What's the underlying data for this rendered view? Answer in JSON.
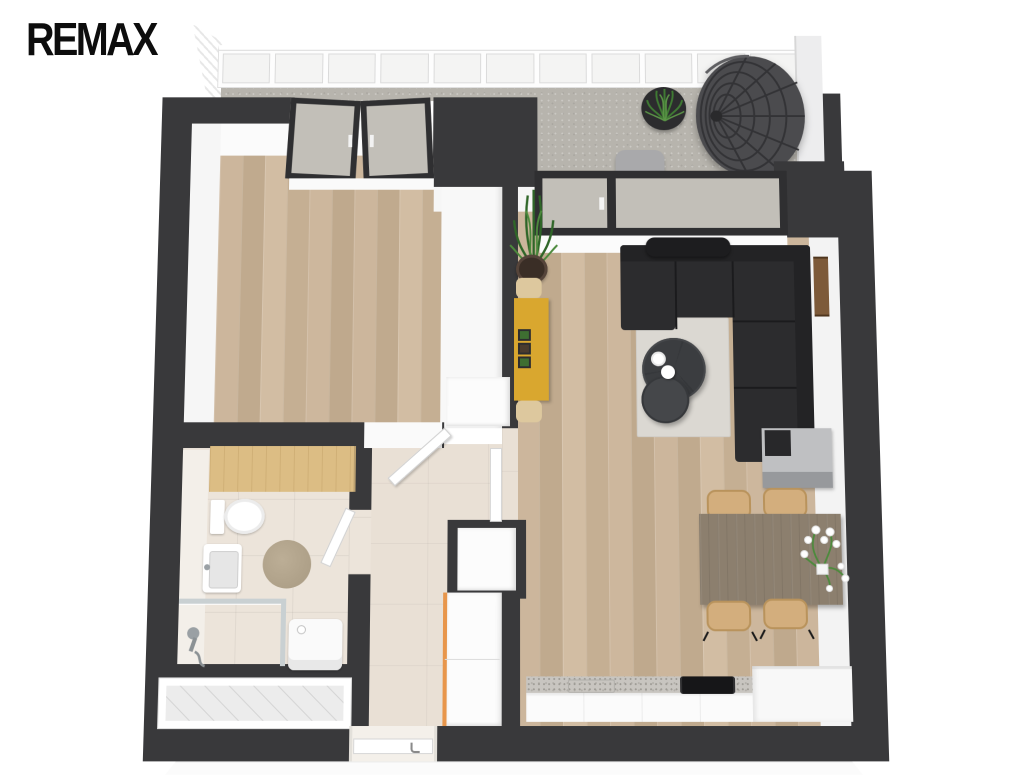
{
  "logo": {
    "text": "REMAX",
    "color": "#0d0d0d"
  },
  "scene": {
    "type": "3d-floor-plan-render",
    "background": "#ffffff",
    "colors": {
      "walls": "#39393b",
      "wood_floor": "#c9b49b",
      "concrete_floor": "#b7b4ad",
      "bath_tile": "#ece4da",
      "hall_tile": "#e9e0d5",
      "sofa": "#2c2c2e",
      "area_rug": "#dbd8d2",
      "dining_table": "#8c7f6e",
      "dining_chair": "#d3ae7d",
      "bench": "#d9a72f",
      "accent_orange": "#e8964b",
      "plant_green": "#3f7a33",
      "countertop": "#c8c5c0"
    },
    "balcony": {
      "railing_panels": 11,
      "furniture": [
        "glass-railing",
        "plant-side-table",
        "outdoor-chair",
        "hanging-egg-chair"
      ]
    },
    "bedroom": {
      "furniture": [
        "french-balcony-doors"
      ]
    },
    "living_room": {
      "furniture": [
        "corner-sofa",
        "headrest-pillow",
        "nesting-coffee-tables",
        "coffee-cup",
        "teapot",
        "area-rug",
        "potted-plant",
        "yellow-bench",
        "planter-boxes",
        "wall-shelf",
        "sideboard",
        "balcony-window",
        "balcony-door"
      ]
    },
    "dining": {
      "chairs": 4,
      "furniture": [
        "dining-table",
        "flower-bouquet"
      ]
    },
    "kitchen": {
      "furniture": [
        "base-counter",
        "speckled-countertop",
        "cooktop",
        "sink"
      ]
    },
    "hallway": {
      "furniture": [
        "wardrobe",
        "entry-door",
        "bedroom-door",
        "bathroom-door",
        "storage-niche"
      ]
    },
    "bathroom": {
      "furniture": [
        "wood-counter",
        "toilet",
        "washbasin",
        "round-rug",
        "shower",
        "hand-shower",
        "glass-screen",
        "washing-machine",
        "bathtub"
      ]
    }
  }
}
